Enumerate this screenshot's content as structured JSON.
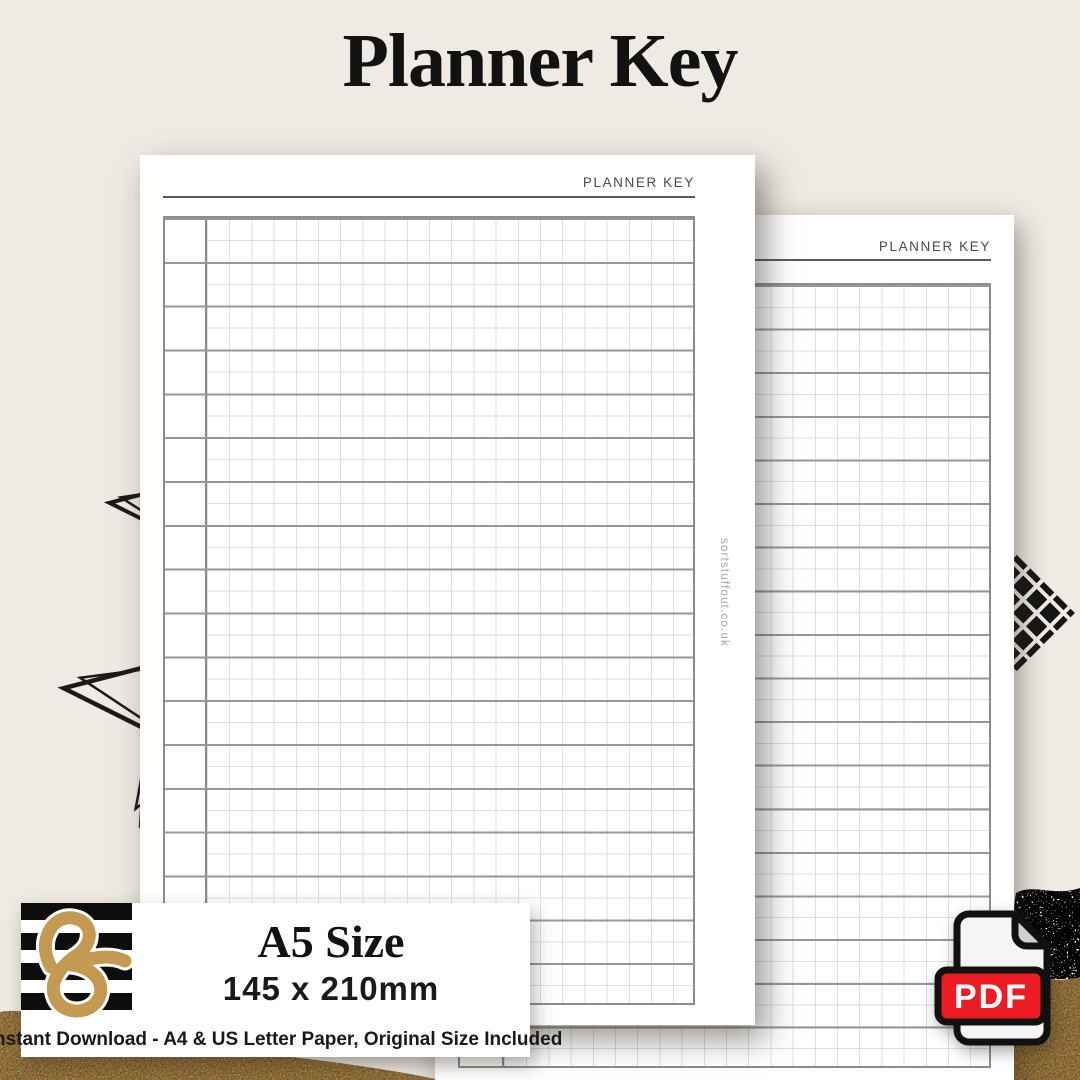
{
  "title": "Planner Key",
  "front_page": {
    "header": "PLANNER KEY",
    "watermark": "sortstuffout.co.uk",
    "grid": {
      "rows": 18,
      "row_subdivision": 2
    }
  },
  "back_page": {
    "header": "PLANNER KEY",
    "grid": {
      "rows": 18,
      "row_subdivision": 2
    }
  },
  "badge": {
    "size_label": "A5 Size",
    "dimensions": "145 x 210mm",
    "footnote": "Instant Download - A4 & US Letter Paper, Original Size Included"
  },
  "pdf_icon": {
    "label": "PDF"
  },
  "colors": {
    "background": "#EFEAE4",
    "accent_red": "#ED1C24",
    "gold": "#C49A52",
    "ink": "#121212"
  }
}
